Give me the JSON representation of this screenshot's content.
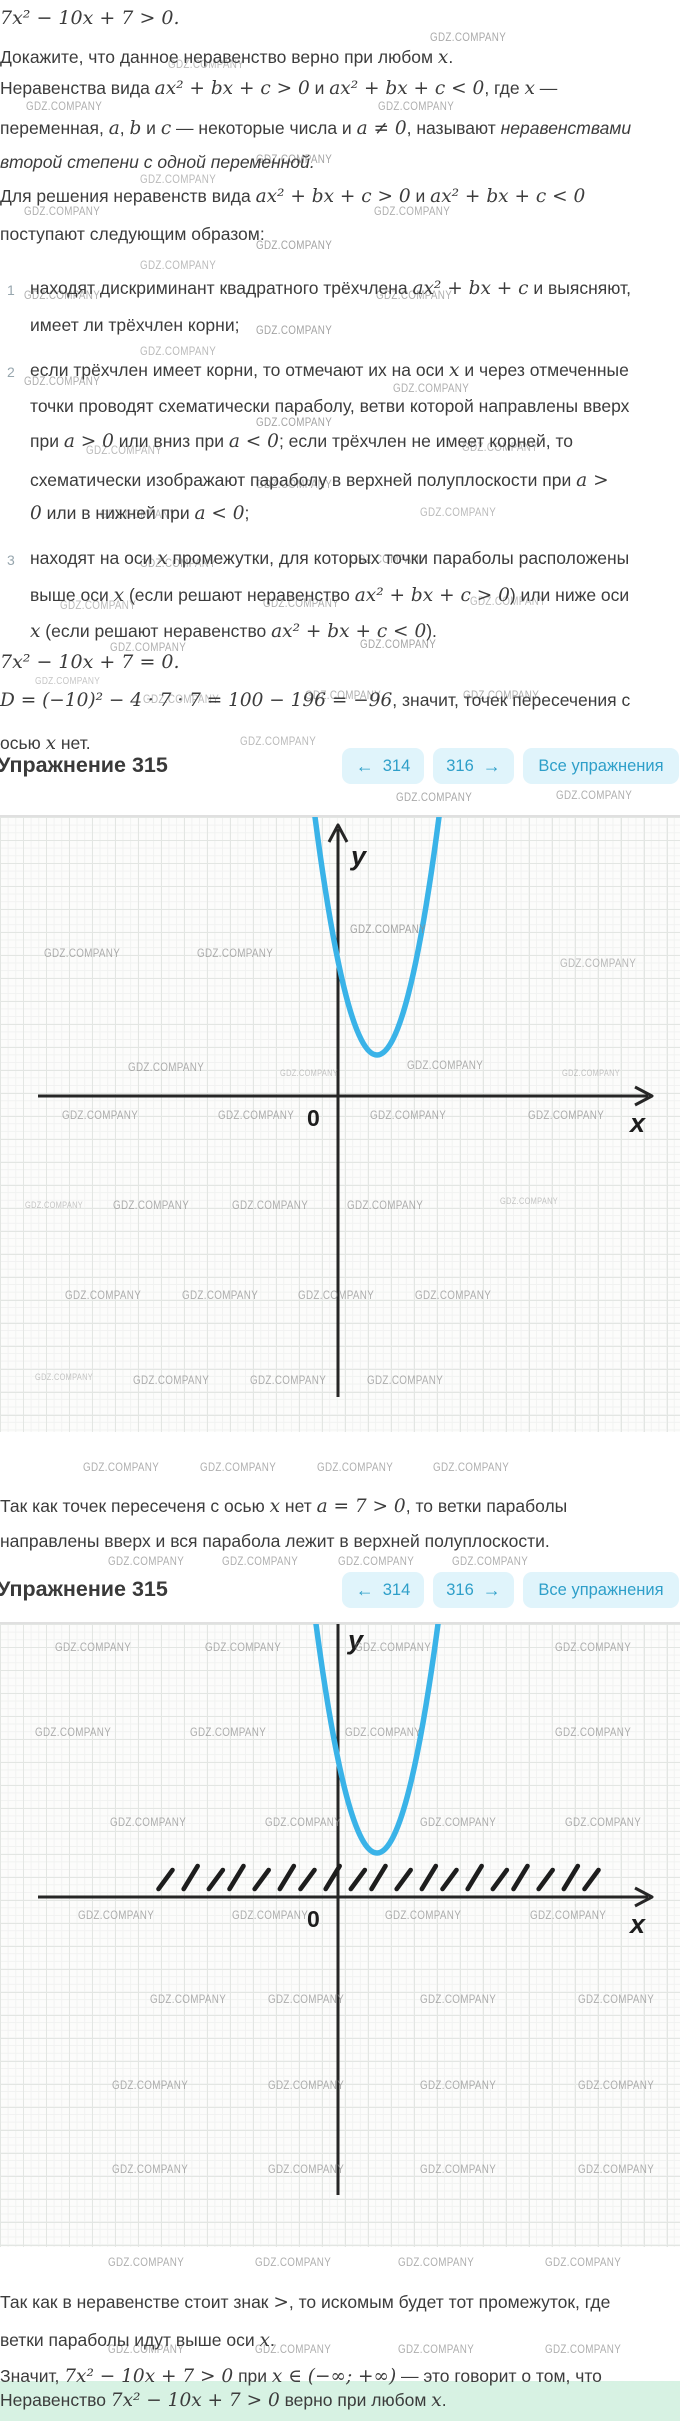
{
  "colors": {
    "curve": "#3ab3e8",
    "axis": "#262626",
    "btnbg": "#e0f4fb",
    "btntx": "#2e9fc9",
    "hl": "#d7f2e3"
  },
  "watermark": {
    "text": "GDZ.COMPANY"
  },
  "header": {
    "title": "Упражнение 315",
    "prev": {
      "icon": "←",
      "label": "314"
    },
    "next": {
      "icon": "→",
      "label": "316"
    },
    "all": {
      "label": "Все упражнения"
    }
  },
  "intro": {
    "lines": [
      {
        "top": 8,
        "math": true,
        "text": "7x² − 10x + 7  >  0."
      },
      {
        "top": 47,
        "text": "Докажите, что данное неравенство верно при любом `x`."
      },
      {
        "top": 78,
        "text": "Неравенства вида `ax² + bx + c  >  0` и `ax² + bx + c  <  0`, где `x` —"
      },
      {
        "top": 118,
        "text": "переменная, `a`, `b` и `c` — некоторые числа и `a ≠ 0`, называют ~неравенствами~"
      },
      {
        "top": 152,
        "it": true,
        "text": "второй степени с одной переменной."
      },
      {
        "top": 186,
        "text": "Для решения неравенств вида `ax² + bx + c  >  0` и `ax² + bx + c  <  0`"
      },
      {
        "top": 224,
        "text": "поступают следующим образом:"
      },
      {
        "top": 278,
        "left": 30,
        "num": "1",
        "text": "находят дискриминант квадратного трёхчлена `ax² + bx + c` и выясняют,"
      },
      {
        "top": 315,
        "left": 30,
        "text": "имеет ли трёхчлен корни;"
      },
      {
        "top": 360,
        "left": 30,
        "num": "2",
        "text": "если трёхчлен имеет корни, то отмечают их на оси `x` и через отмеченные"
      },
      {
        "top": 396,
        "left": 30,
        "text": "точки проводят схематически параболу, ветви которой направлены вверх"
      },
      {
        "top": 431,
        "left": 30,
        "text": "при `a  >  0` или вниз при `a  <  0`; если трёхчлен не имеет корней, то"
      },
      {
        "top": 470,
        "left": 30,
        "text": "схематически изображают параболу в верхней полуплоскости при `a  >`"
      },
      {
        "top": 503,
        "left": 30,
        "text": "`0` или в нижней при `a  <  0`;"
      },
      {
        "top": 548,
        "left": 30,
        "num": "3",
        "text": "находят на оси `x` промежутки, для которых точки параболы расположены"
      },
      {
        "top": 585,
        "left": 30,
        "text": "выше оси `x` (если решают неравенство `ax² + bx + c  >  0`) или ниже оси"
      },
      {
        "top": 621,
        "left": 30,
        "text": "`x` (если решают неравенство `ax² + bx + c  <  0`)."
      },
      {
        "top": 652,
        "math": true,
        "text": "7x² − 10x + 7  =  0."
      },
      {
        "top": 690,
        "text": "`D = (−10)² − 4 · 7 · 7 = 100 − 196 = −96`, значит, точек пересечения с"
      },
      {
        "top": 733,
        "text": "осью `x` нет."
      }
    ]
  },
  "mid": {
    "lines": [
      {
        "top": 1496,
        "text": "Так как точек пересеченя с осью `x` нет `a = 7  >  0`, то ветки параболы"
      },
      {
        "top": 1531,
        "text": "направлены вверх и вся парабола лежит в верхней полуплоскости."
      }
    ]
  },
  "bottom": {
    "lines": [
      {
        "top": 2292,
        "text": "Так как в неравенстве стоит знак `>`, то искомым будет тот промежуток, где"
      },
      {
        "top": 2330,
        "text": "ветки параболы идут выше оси `x`."
      },
      {
        "top": 2366,
        "text": "Значит, `7x² − 10x + 7  >  0` при `x ∈ (−∞; +∞)` — это говорит о том, что"
      },
      {
        "top": 2390,
        "text": "Неравенство `7x² − 10x + 7  >  0` верно при любом `x`."
      }
    ]
  },
  "highlight_band": {
    "top": 2381,
    "height": 40
  },
  "chart_data": [
    {
      "type": "line",
      "subtype": "parabola-schematic",
      "function": "y = 7x² − 10x + 7",
      "opens": "up",
      "vertex_location": "above x-axis, right of y-axis",
      "x_intercepts": [],
      "grid": true,
      "axis_labels": {
        "x": "x",
        "y": "y",
        "origin": "0"
      },
      "curve_color": "#3ab3e8",
      "solution_hatch": false
    },
    {
      "type": "line",
      "subtype": "parabola-schematic",
      "function": "y = 7x² − 10x + 7",
      "opens": "up",
      "vertex_location": "above x-axis, right of y-axis",
      "x_intercepts": [],
      "grid": true,
      "axis_labels": {
        "x": "x",
        "y": "y",
        "origin": "0"
      },
      "curve_color": "#3ab3e8",
      "solution_hatch": true,
      "solution_interval": "(−∞; +∞)"
    }
  ],
  "graphs": [
    {
      "top": 815,
      "height": 615,
      "axis_x_y": 279,
      "axis_y_x": 338,
      "vertex": [
        377,
        238
      ],
      "halfwidth_top": 62,
      "x_axis_from": 38,
      "x_axis_to": 652,
      "y_axis_from": 6,
      "y_axis_to": 580,
      "y_arrow": true,
      "hatch": null,
      "labels": {
        "y": "y",
        "x": "x",
        "o": "0"
      },
      "label_pos": {
        "y": [
          351,
          24
        ],
        "x": [
          630,
          291
        ],
        "o": [
          307,
          288
        ]
      }
    },
    {
      "top": 1622,
      "height": 623,
      "axis_x_y": 273,
      "axis_y_x": 338,
      "vertex": [
        377,
        229
      ],
      "halfwidth_top": 61,
      "x_axis_from": 38,
      "x_axis_to": 652,
      "y_axis_from": 0,
      "y_axis_to": 571,
      "y_arrow": false,
      "hatch": {
        "x1": 160,
        "x2": 586,
        "count": 19,
        "dy1": 8,
        "dy2": 31,
        "dx": 14
      },
      "labels": {
        "y": "y",
        "x": "x",
        "o": "0"
      },
      "label_pos": {
        "y": [
          348,
          1
        ],
        "x": [
          630,
          285
        ],
        "o": [
          307,
          282
        ]
      }
    }
  ],
  "watermarks": [
    [
      430,
      30,
      1,
      0.75
    ],
    [
      168,
      57,
      1,
      0.6
    ],
    [
      26,
      99,
      1,
      0.7
    ],
    [
      378,
      99,
      1,
      0.7
    ],
    [
      256,
      152,
      1,
      0.8
    ],
    [
      140,
      172,
      1,
      0.6
    ],
    [
      24,
      204,
      1,
      0.7
    ],
    [
      374,
      204,
      1,
      0.7
    ],
    [
      256,
      238,
      1,
      0.8
    ],
    [
      140,
      258,
      1,
      0.6
    ],
    [
      24,
      288,
      1,
      0.7
    ],
    [
      376,
      288,
      1,
      0.7
    ],
    [
      256,
      323,
      1,
      0.8
    ],
    [
      140,
      344,
      1,
      0.6
    ],
    [
      24,
      374,
      1,
      0.7
    ],
    [
      393,
      381,
      1,
      0.7
    ],
    [
      256,
      415,
      1,
      0.8
    ],
    [
      86,
      443,
      1,
      0.6
    ],
    [
      462,
      440,
      1,
      0.6
    ],
    [
      256,
      477,
      1,
      0.7
    ],
    [
      100,
      507,
      1,
      0.6
    ],
    [
      420,
      505,
      1,
      0.6
    ],
    [
      140,
      556,
      1,
      0.7
    ],
    [
      350,
      552,
      1,
      0.7
    ],
    [
      60,
      598,
      1,
      0.6
    ],
    [
      263,
      596,
      1,
      0.7
    ],
    [
      470,
      594,
      1,
      0.6
    ],
    [
      110,
      640,
      1,
      0.7
    ],
    [
      360,
      637,
      1,
      0.8
    ],
    [
      35,
      676,
      0.85,
      0.5
    ],
    [
      143,
      692,
      1,
      0.6
    ],
    [
      305,
      688,
      1,
      0.7
    ],
    [
      463,
      688,
      1,
      0.7
    ],
    [
      240,
      734,
      1,
      0.6
    ],
    [
      396,
      790,
      1,
      0.75
    ],
    [
      556,
      788,
      1,
      0.7
    ],
    [
      350,
      922,
      1,
      0.8
    ],
    [
      44,
      946,
      1,
      0.7
    ],
    [
      197,
      946,
      1,
      0.7
    ],
    [
      560,
      956,
      1,
      0.6
    ],
    [
      128,
      1060,
      1,
      0.7
    ],
    [
      280,
      1068,
      0.75,
      0.5
    ],
    [
      407,
      1058,
      1,
      0.7
    ],
    [
      562,
      1068,
      0.75,
      0.5
    ],
    [
      62,
      1108,
      1,
      0.7
    ],
    [
      218,
      1108,
      1,
      0.7
    ],
    [
      370,
      1108,
      1,
      0.7
    ],
    [
      528,
      1108,
      1,
      0.7
    ],
    [
      25,
      1200,
      0.75,
      0.5
    ],
    [
      113,
      1198,
      1,
      0.7
    ],
    [
      232,
      1198,
      1,
      0.7
    ],
    [
      347,
      1198,
      1,
      0.7
    ],
    [
      500,
      1196,
      0.75,
      0.5
    ],
    [
      65,
      1288,
      1,
      0.7
    ],
    [
      182,
      1288,
      1,
      0.7
    ],
    [
      298,
      1288,
      1,
      0.7
    ],
    [
      415,
      1288,
      1,
      0.7
    ],
    [
      35,
      1372,
      0.75,
      0.5
    ],
    [
      133,
      1373,
      1,
      0.7
    ],
    [
      250,
      1373,
      1,
      0.7
    ],
    [
      367,
      1373,
      1,
      0.7
    ],
    [
      83,
      1460,
      1,
      0.7
    ],
    [
      200,
      1460,
      1,
      0.7
    ],
    [
      317,
      1460,
      1,
      0.7
    ],
    [
      433,
      1460,
      1,
      0.7
    ],
    [
      108,
      1554,
      1,
      0.7
    ],
    [
      222,
      1554,
      1,
      0.7
    ],
    [
      338,
      1554,
      1,
      0.7
    ],
    [
      452,
      1554,
      1,
      0.7
    ],
    [
      55,
      1640,
      1,
      0.7
    ],
    [
      205,
      1640,
      1,
      0.7
    ],
    [
      355,
      1640,
      1,
      0.7
    ],
    [
      555,
      1640,
      1,
      0.7
    ],
    [
      35,
      1725,
      1,
      0.7
    ],
    [
      190,
      1725,
      1,
      0.7
    ],
    [
      345,
      1725,
      1,
      0.7
    ],
    [
      555,
      1725,
      1,
      0.7
    ],
    [
      110,
      1815,
      1,
      0.7
    ],
    [
      265,
      1815,
      1,
      0.7
    ],
    [
      420,
      1815,
      1,
      0.7
    ],
    [
      565,
      1815,
      1,
      0.7
    ],
    [
      78,
      1908,
      1,
      0.7
    ],
    [
      232,
      1908,
      1,
      0.7
    ],
    [
      385,
      1908,
      1,
      0.7
    ],
    [
      530,
      1908,
      1,
      0.7
    ],
    [
      150,
      1992,
      1,
      0.7
    ],
    [
      268,
      1992,
      1,
      0.7
    ],
    [
      420,
      1992,
      1,
      0.7
    ],
    [
      578,
      1992,
      1,
      0.7
    ],
    [
      112,
      2078,
      1,
      0.7
    ],
    [
      268,
      2078,
      1,
      0.7
    ],
    [
      420,
      2078,
      1,
      0.7
    ],
    [
      578,
      2078,
      1,
      0.7
    ],
    [
      112,
      2162,
      1,
      0.7
    ],
    [
      268,
      2162,
      1,
      0.7
    ],
    [
      420,
      2162,
      1,
      0.7
    ],
    [
      578,
      2162,
      1,
      0.7
    ],
    [
      108,
      2255,
      1,
      0.7
    ],
    [
      255,
      2255,
      1,
      0.7
    ],
    [
      398,
      2255,
      1,
      0.7
    ],
    [
      545,
      2255,
      1,
      0.7
    ],
    [
      108,
      2342,
      1,
      0.7
    ],
    [
      255,
      2342,
      1,
      0.7
    ],
    [
      398,
      2342,
      1,
      0.7
    ],
    [
      545,
      2342,
      1,
      0.7
    ]
  ]
}
